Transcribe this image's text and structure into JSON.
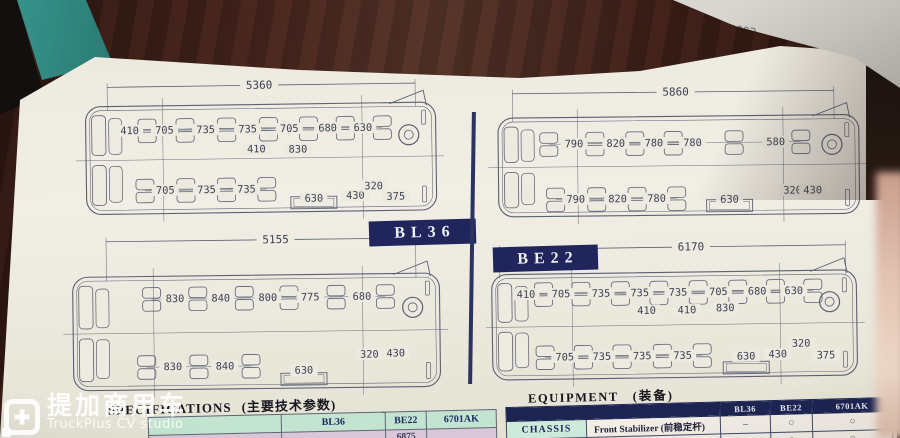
{
  "colors": {
    "navy_badge": "#20265c",
    "equip_header_navy": "#1c2452",
    "table_green": "#c2e4d0",
    "table_pink": "#d9c6d8",
    "paper": "#edeadf",
    "wood": "#45241d",
    "teal_spine": "#38978e",
    "diagram_line": "#5b6073"
  },
  "models": {
    "bl36": "BL36",
    "be22": "BE22"
  },
  "corner_stamp": {
    "text": "C000398 3M-2"
  },
  "watermark": {
    "cn": "提加商用车",
    "en": "TruckPlus CV studio"
  },
  "spec_table": {
    "heading_en": "SPECIFICATIONS",
    "heading_cn": "(主要技术参数)",
    "columns": [
      "BL36",
      "BE22",
      "6701AK"
    ],
    "partial_row": [
      "",
      "6875",
      ""
    ]
  },
  "equipment_table": {
    "heading_en": "EQUIPMENT",
    "heading_cn": "(装备)",
    "columns": [
      "BL36",
      "BE22",
      "6701AK"
    ],
    "rows": [
      {
        "group": "CHASSIS",
        "item": "Front Stabilizer (前稳定杆)",
        "values": [
          "–",
          "○",
          "○"
        ]
      }
    ],
    "partial_row": {
      "values": [
        "○",
        "○",
        "○"
      ]
    }
  },
  "diagrams": [
    {
      "name": "floorplan-5360",
      "dim": {
        "label": "5360",
        "x1": 0.125,
        "x2": 0.895,
        "y": 0.06,
        "lx": 0.505
      },
      "bus": {
        "x1": 0.07,
        "y1": 0.185,
        "x2": 0.945,
        "y2": 0.885
      },
      "top": {
        "y": 0.345,
        "labels": [
          {
            "t": "410",
            "x": 0.18
          },
          {
            "t": "705",
            "x": 0.267
          },
          {
            "t": "735",
            "x": 0.37
          },
          {
            "t": "735",
            "x": 0.475
          },
          {
            "t": "705",
            "x": 0.579
          },
          {
            "t": "680",
            "x": 0.675
          },
          {
            "t": "630",
            "x": 0.763
          }
        ]
      },
      "mid": [
        {
          "t": "410",
          "x": 0.496,
          "y": 0.475
        },
        {
          "t": "830",
          "x": 0.6,
          "y": 0.48
        }
      ],
      "bottom": {
        "y": 0.735,
        "labels": [
          {
            "t": "705",
            "x": 0.267
          },
          {
            "t": "735",
            "x": 0.37
          },
          {
            "t": "735",
            "x": 0.47
          }
        ]
      },
      "extras": [
        {
          "t": "630",
          "x": 0.638,
          "y": 0.8,
          "door": true
        },
        {
          "t": "430",
          "x": 0.742,
          "y": 0.785
        },
        {
          "t": "320",
          "x": 0.788,
          "y": 0.725
        },
        {
          "t": "375",
          "x": 0.843,
          "y": 0.795
        }
      ]
    },
    {
      "name": "floorplan-5860",
      "dim": {
        "label": "5860",
        "x1": 0.066,
        "x2": 0.85,
        "y": 0.065,
        "lx": 0.464
      },
      "bus": {
        "x1": 0.03,
        "y1": 0.225,
        "x2": 0.91,
        "y2": 0.875
      },
      "top": {
        "y": 0.4,
        "labels": [
          {
            "t": "790",
            "x": 0.215
          },
          {
            "t": "820",
            "x": 0.317
          },
          {
            "t": "780",
            "x": 0.41
          },
          {
            "t": "780",
            "x": 0.504
          },
          {
            "t": "580",
            "x": 0.707
          }
        ]
      },
      "mid": [],
      "bottom": {
        "y": 0.765,
        "labels": [
          {
            "t": "790",
            "x": 0.218
          },
          {
            "t": "820",
            "x": 0.32
          },
          {
            "t": "780",
            "x": 0.415
          }
        ]
      },
      "extras": [
        {
          "t": "630",
          "x": 0.593,
          "y": 0.775,
          "door": true
        },
        {
          "t": "320",
          "x": 0.747,
          "y": 0.72
        },
        {
          "t": "430",
          "x": 0.796,
          "y": 0.72
        }
      ]
    },
    {
      "name": "floorplan-5155",
      "dim": {
        "label": "5155",
        "x1": 0.12,
        "x2": 0.85,
        "y": 0.07,
        "lx": 0.52
      },
      "bus": {
        "x1": 0.04,
        "y1": 0.28,
        "x2": 0.905,
        "y2": 0.955
      },
      "top": {
        "y": 0.415,
        "labels": [
          {
            "t": "830",
            "x": 0.281
          },
          {
            "t": "840",
            "x": 0.389
          },
          {
            "t": "800",
            "x": 0.5
          },
          {
            "t": "775",
            "x": 0.6
          },
          {
            "t": "680",
            "x": 0.722
          }
        ]
      },
      "mid": [],
      "bottom": {
        "y": 0.82,
        "labels": [
          {
            "t": "830",
            "x": 0.274
          },
          {
            "t": "840",
            "x": 0.397
          }
        ]
      },
      "extras": [
        {
          "t": "630",
          "x": 0.583,
          "y": 0.85,
          "door": true
        },
        {
          "t": "320",
          "x": 0.738,
          "y": 0.76
        },
        {
          "t": "430",
          "x": 0.8,
          "y": 0.755
        }
      ]
    },
    {
      "name": "floorplan-6170",
      "dim": {
        "label": "6170",
        "x1": 0.035,
        "x2": 0.875,
        "y": 0.055,
        "lx": 0.5
      },
      "bus": {
        "x1": 0.015,
        "y1": 0.21,
        "x2": 0.9,
        "y2": 0.86
      },
      "top": {
        "y": 0.335,
        "labels": [
          {
            "t": "410",
            "x": 0.098
          },
          {
            "t": "705",
            "x": 0.183
          },
          {
            "t": "735",
            "x": 0.28
          },
          {
            "t": "735",
            "x": 0.374
          },
          {
            "t": "735",
            "x": 0.467
          },
          {
            "t": "705",
            "x": 0.565
          },
          {
            "t": "680",
            "x": 0.659
          },
          {
            "t": "630",
            "x": 0.748
          }
        ]
      },
      "mid": [
        {
          "t": "410",
          "x": 0.39,
          "y": 0.445
        },
        {
          "t": "410",
          "x": 0.488,
          "y": 0.445
        },
        {
          "t": "830",
          "x": 0.581,
          "y": 0.435
        }
      ],
      "bottom": {
        "y": 0.725,
        "labels": [
          {
            "t": "705",
            "x": 0.19
          },
          {
            "t": "735",
            "x": 0.28
          },
          {
            "t": "735",
            "x": 0.378
          },
          {
            "t": "735",
            "x": 0.476
          }
        ]
      },
      "extras": [
        {
          "t": "630",
          "x": 0.63,
          "y": 0.735,
          "door": true
        },
        {
          "t": "430",
          "x": 0.707,
          "y": 0.725
        },
        {
          "t": "320",
          "x": 0.764,
          "y": 0.66
        },
        {
          "t": "375",
          "x": 0.824,
          "y": 0.735
        }
      ]
    }
  ]
}
